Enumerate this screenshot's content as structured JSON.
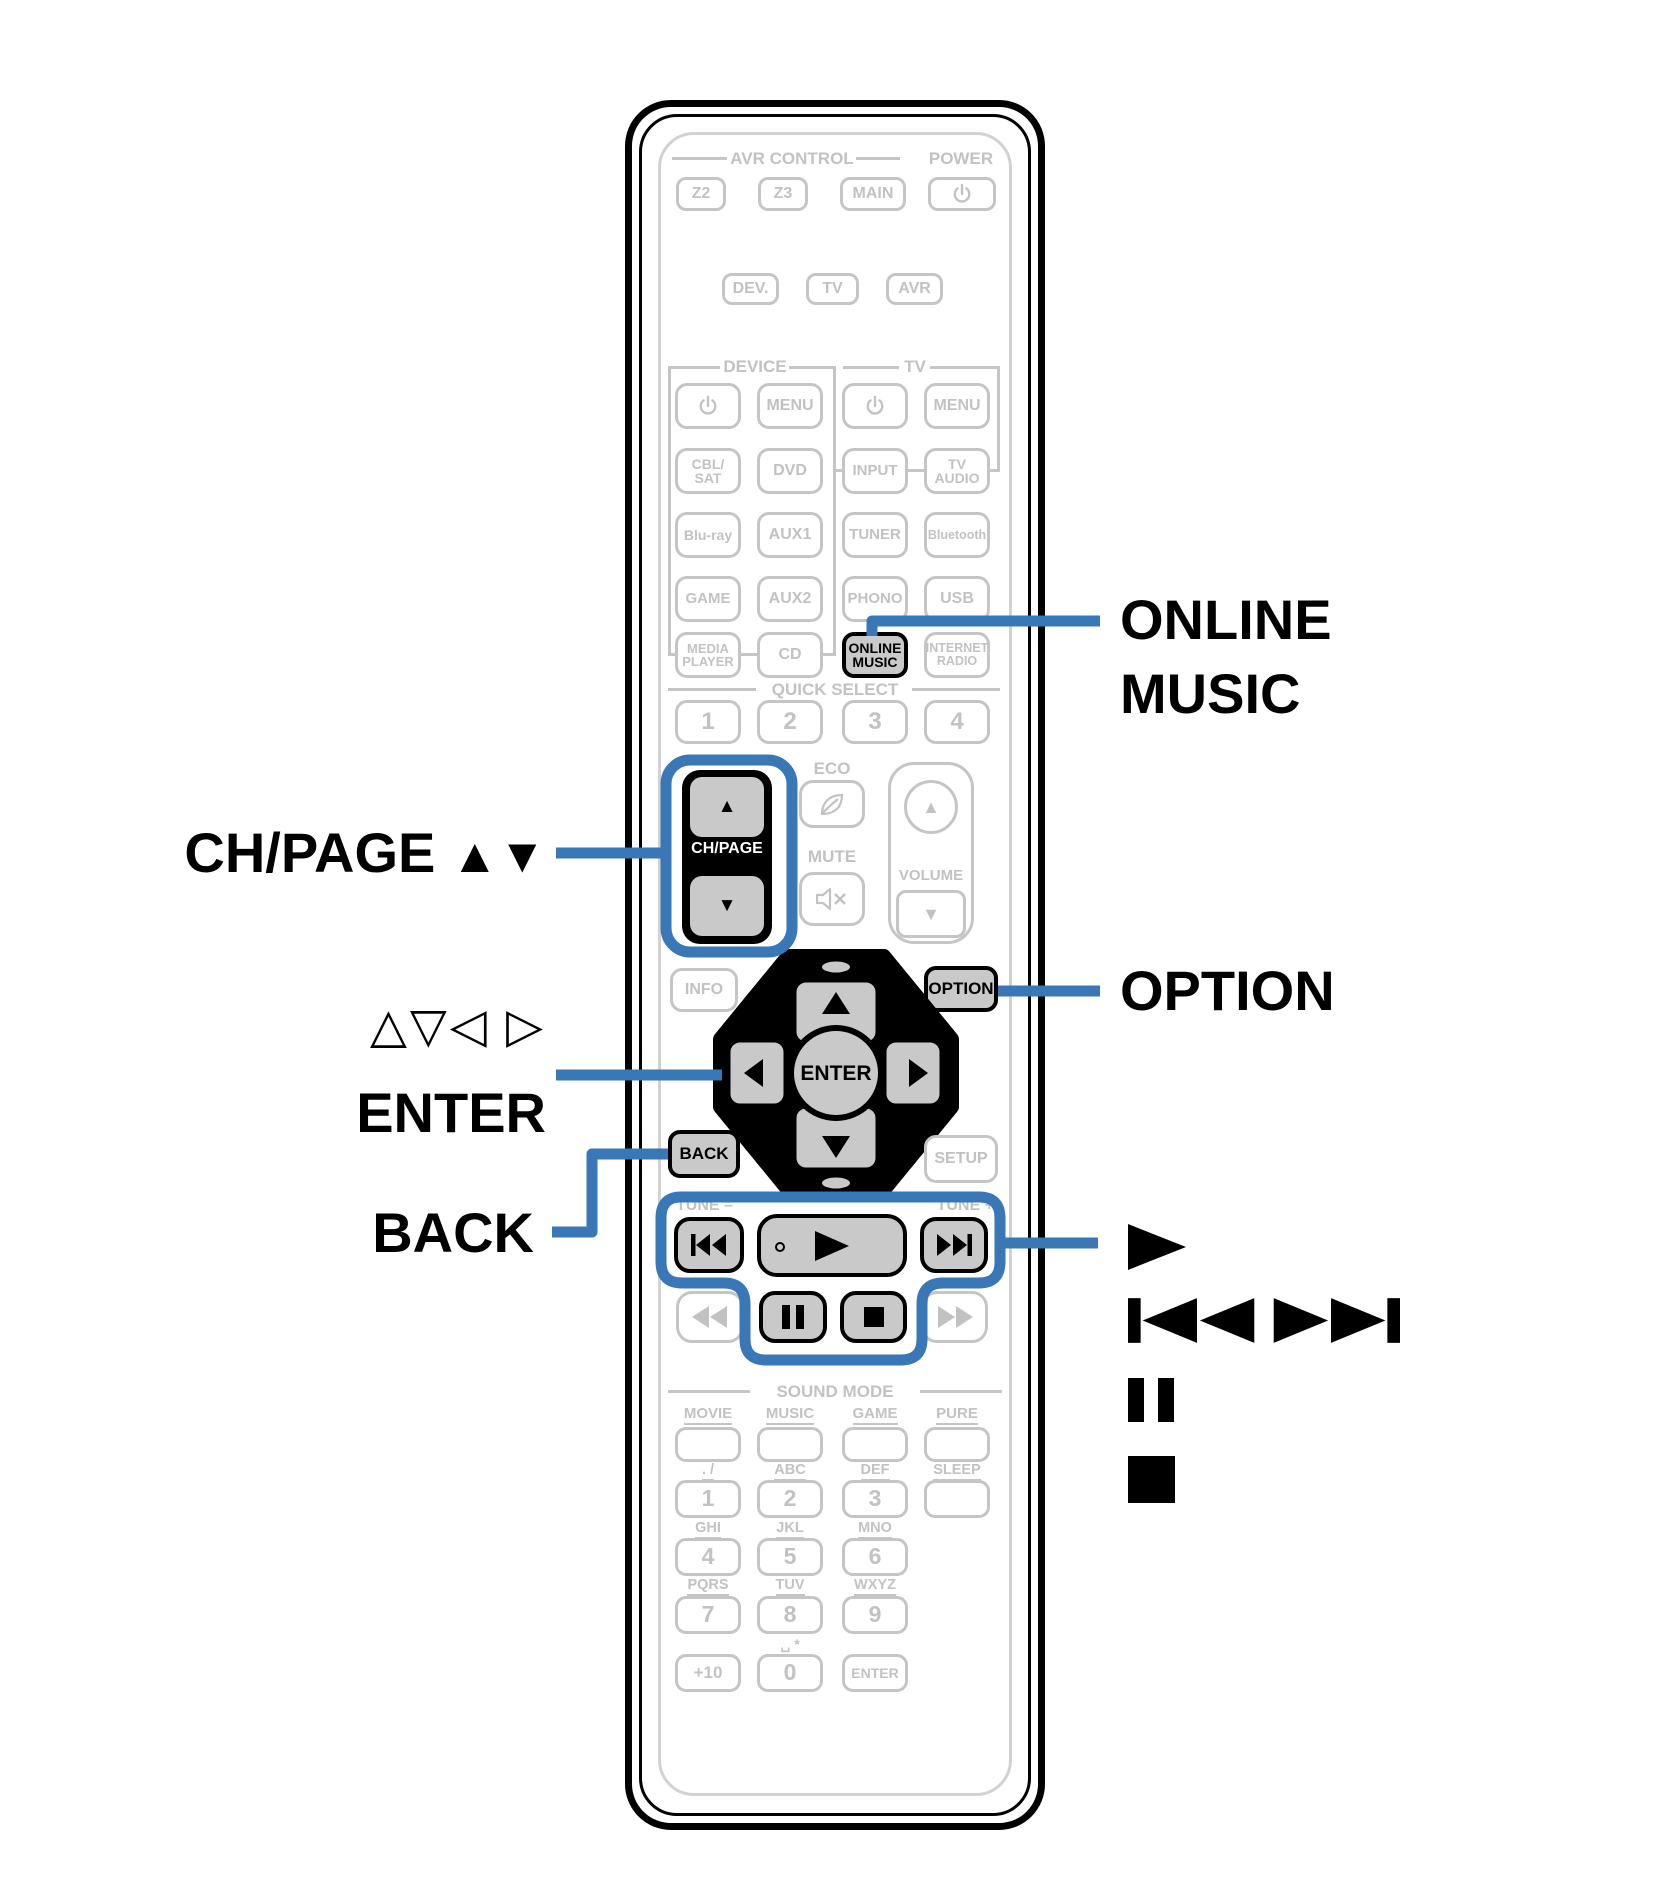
{
  "accent": {
    "callout_blue": "#3a77b6",
    "highlight_gray": "#c9c9c9",
    "art_gray": "#c5c5c5"
  },
  "callouts": {
    "online_music": {
      "line1": "ONLINE",
      "line2": "MUSIC"
    },
    "ch_page": {
      "text": "CH/PAGE",
      "arrows": "▲▼"
    },
    "cursor_arrows": "△▽◁ ▷",
    "enter": "ENTER",
    "back": "BACK",
    "option": "OPTION"
  },
  "remote": {
    "top": {
      "avr_control": "AVR CONTROL",
      "power": "POWER",
      "zone_buttons": [
        "Z2",
        "Z3",
        "MAIN"
      ],
      "mode_buttons": [
        "DEV.",
        "TV",
        "AVR"
      ]
    },
    "groups": {
      "device": "DEVICE",
      "tv": "TV"
    },
    "source_grid": {
      "row1": [
        "MENU",
        "MENU"
      ],
      "row2": [
        "CBL/\nSAT",
        "DVD",
        "INPUT",
        "TV\nAUDIO"
      ],
      "row3": [
        "Blu-ray",
        "AUX1",
        "TUNER",
        "Bluetooth"
      ],
      "row4": [
        "GAME",
        "AUX2",
        "PHONO",
        "USB"
      ],
      "row5": [
        "MEDIA\nPLAYER",
        "CD",
        "ONLINE\nMUSIC",
        "INTERNET\nRADIO"
      ]
    },
    "quick_select": {
      "label": "QUICK SELECT",
      "buttons": [
        "1",
        "2",
        "3",
        "4"
      ]
    },
    "volume_cluster": {
      "eco": "ECO",
      "ch_page": "CH/PAGE",
      "mute": "MUTE",
      "volume": "VOLUME"
    },
    "nav": {
      "info": "INFO",
      "option": "OPTION",
      "enter": "ENTER",
      "back": "BACK",
      "setup": "SETUP"
    },
    "tuner": {
      "tune_minus": "TUNE –",
      "tune_plus": "TUNE +"
    },
    "sound_mode": {
      "label": "SOUND MODE",
      "modes": [
        "MOVIE",
        "MUSIC",
        "GAME",
        "PURE"
      ],
      "sleep": "SLEEP"
    },
    "numpad": {
      "tap_labels": [
        ". /",
        "ABC",
        "DEF",
        "GHI",
        "JKL",
        "MNO",
        "PQRS",
        "TUV",
        "WXYZ"
      ],
      "digits": [
        "1",
        "2",
        "3",
        "4",
        "5",
        "6",
        "7",
        "8",
        "9"
      ],
      "zero_tap_label": "␣ *",
      "bottom": [
        "+10",
        "0",
        "ENTER"
      ]
    }
  }
}
